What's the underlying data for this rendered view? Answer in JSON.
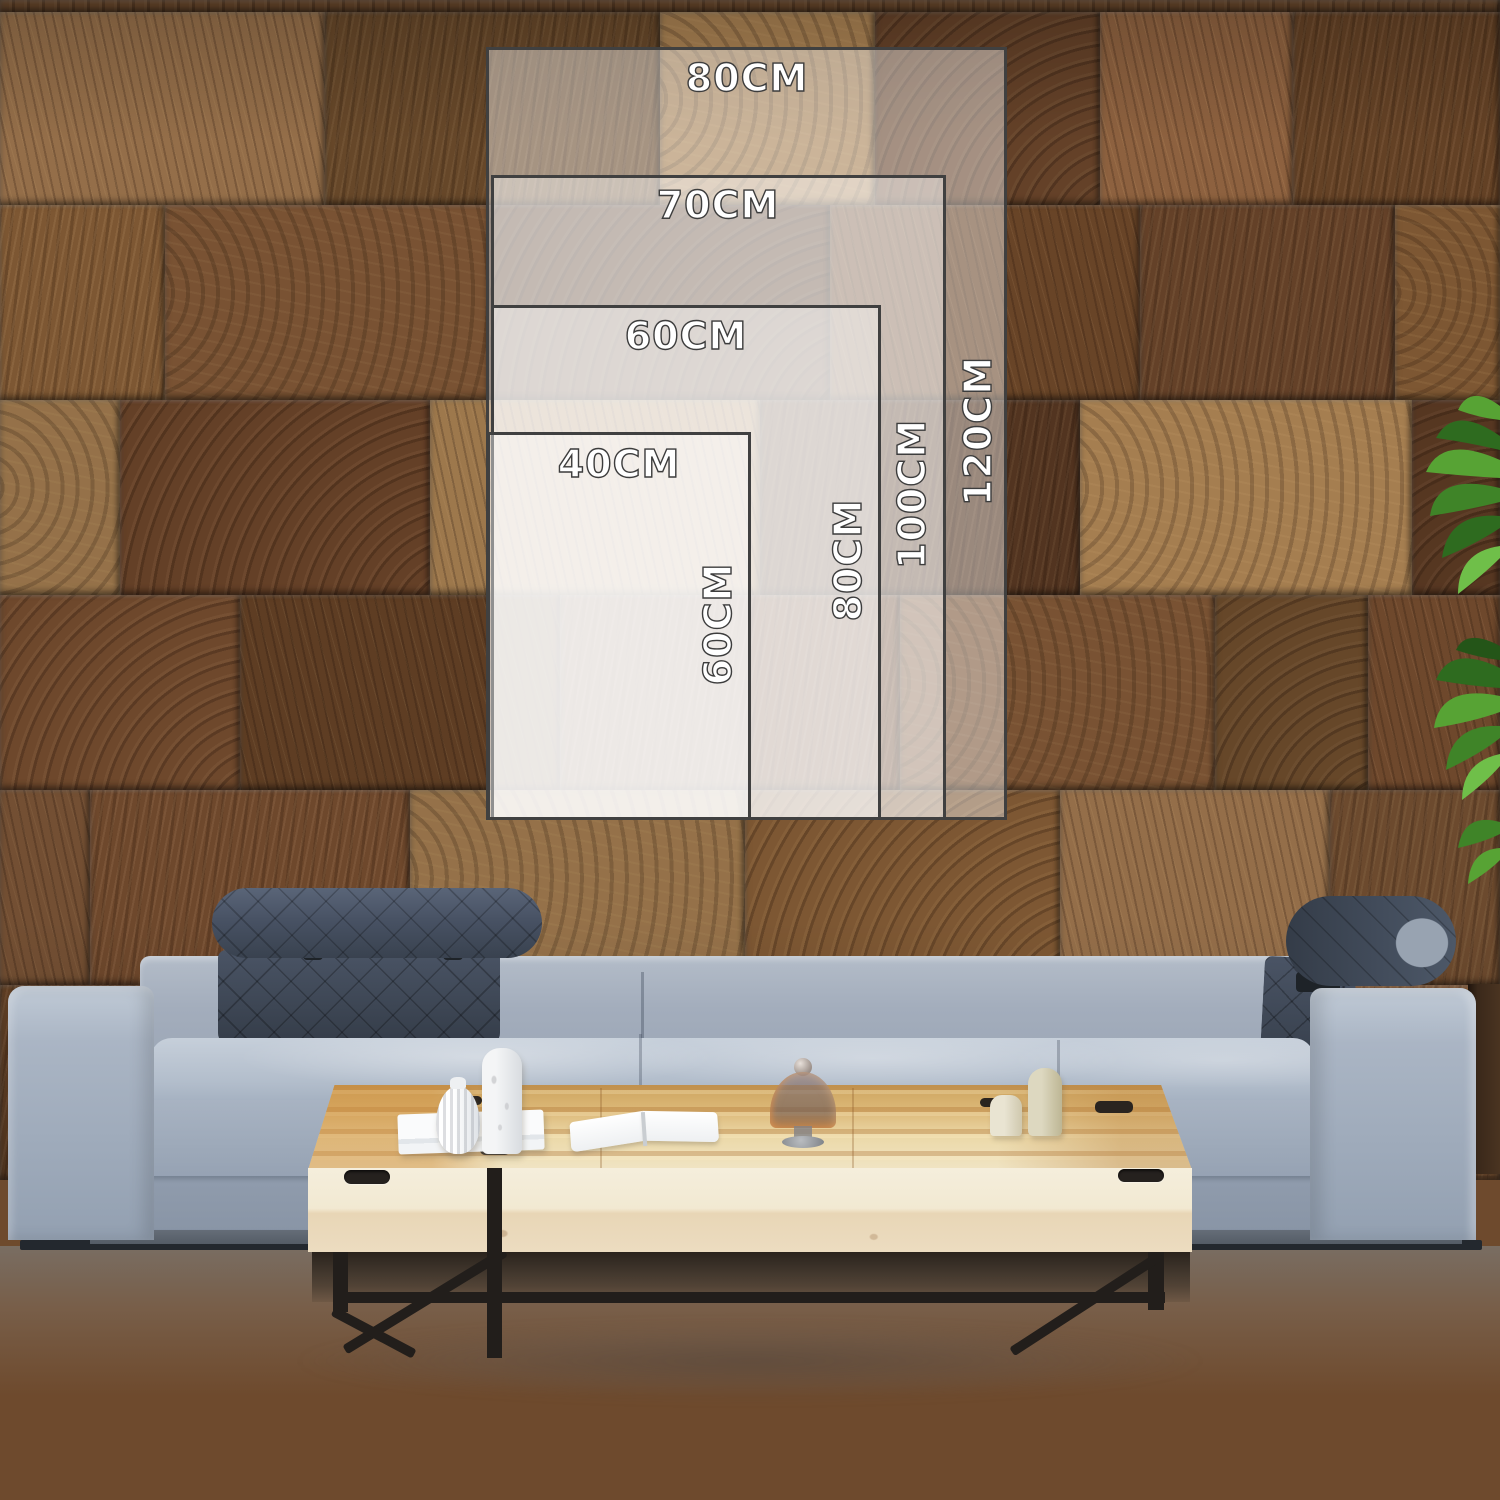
{
  "size_chart": {
    "unit": "CM",
    "sizes": [
      {
        "name": "40x60",
        "width_label": "40CM",
        "height_label": "60CM"
      },
      {
        "name": "60x80",
        "width_label": "60CM",
        "height_label": "80CM"
      },
      {
        "name": "70x100",
        "width_label": "70CM",
        "height_label": "100CM"
      },
      {
        "name": "80x120",
        "width_label": "80CM",
        "height_label": "120CM"
      }
    ],
    "overlay_fill": "rgba(255,255,255,0.42)",
    "border_color": "#404040",
    "label_text_color": "#ffffff",
    "label_outline_color": "#3d3d3d"
  },
  "scene_colors": {
    "wall_wood_mid": "#7b5434",
    "wall_wood_dark": "#5d3b24",
    "wall_wood_light": "#97704a",
    "sofa_fabric": "#a8b3c2",
    "headrest_fabric": "#46505f",
    "table_wood_top": "#dcb878",
    "table_wood_face": "#f2e9d2",
    "table_metal_leg": "#221e1b",
    "floor": "#e9ebe9",
    "plant_leaf": "#4e9733"
  }
}
